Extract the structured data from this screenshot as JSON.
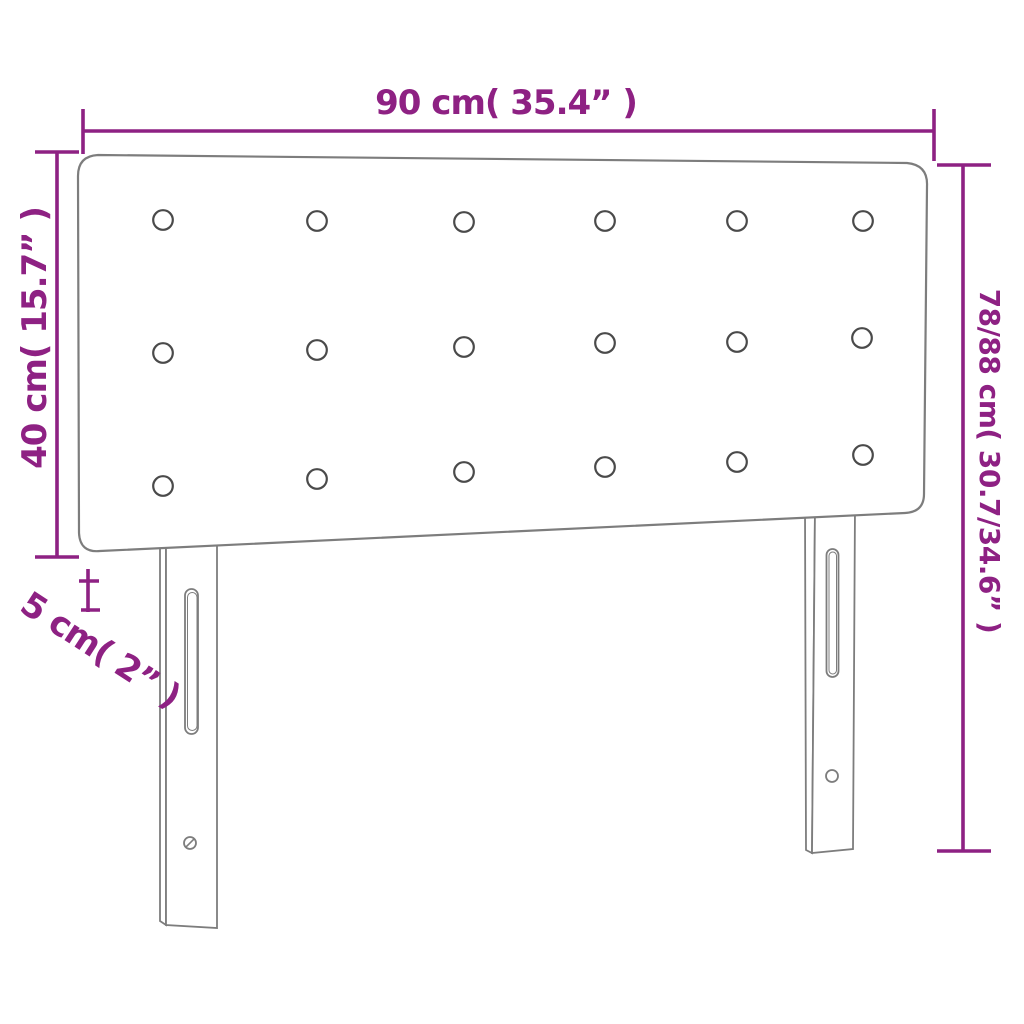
{
  "diagram": {
    "type": "product-dimension-diagram",
    "product": "upholstered headboard with two mounting legs",
    "labels": {
      "width": "90 cm( 35.4” )",
      "panel_height": "40 cm( 15.7” )",
      "thickness": "5 cm( 2” )",
      "total_height": "78/88 cm( 30.7/34.6” )"
    },
    "measurements": {
      "width_cm": "90",
      "width_inches": "35.4",
      "panel_height_cm": "40",
      "panel_height_inches": "15.7",
      "thickness_cm": "5",
      "thickness_inches": "2",
      "total_height_cm": "78/88",
      "total_height_inches": "30.7/34.6"
    },
    "tufting_buttons": {
      "rows": 3,
      "columns": 6,
      "count": 18
    }
  },
  "colors": {
    "dimension": "#8e2183",
    "outline": "#7d7d7d",
    "button-stroke": "#4a4a4a",
    "background": "#ffffff"
  }
}
